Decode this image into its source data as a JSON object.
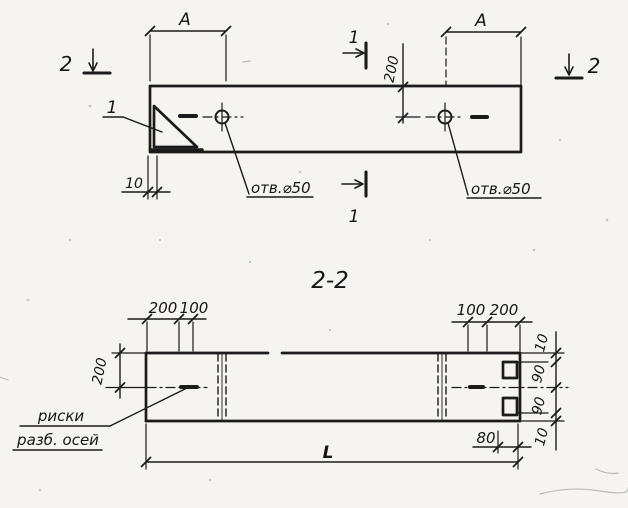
{
  "sheet": {
    "plan": {
      "dim_a_left": "A",
      "dim_a_right": "A",
      "dim_200": "200",
      "dim_10": "10",
      "callout_1": "1",
      "hole_left_label": "отв.⌀50",
      "hole_right_label": "отв.⌀50",
      "marker_1_top": "1",
      "marker_1_bottom": "1",
      "marker_2_left": "2",
      "marker_2_right": "2"
    },
    "section": {
      "title": "2-2",
      "dim_200_left": "200",
      "dims_top_left": [
        "200",
        "100"
      ],
      "dims_top_right": [
        "100",
        "200"
      ],
      "dims_right": [
        "10",
        "90",
        "90",
        "10"
      ],
      "dim_80": "80",
      "dim_L": "L",
      "note_line1": "риски",
      "note_line2": "разб. осей"
    },
    "colors": {
      "ink": "#1b1b1b",
      "paper": "#f5f4f0"
    }
  }
}
